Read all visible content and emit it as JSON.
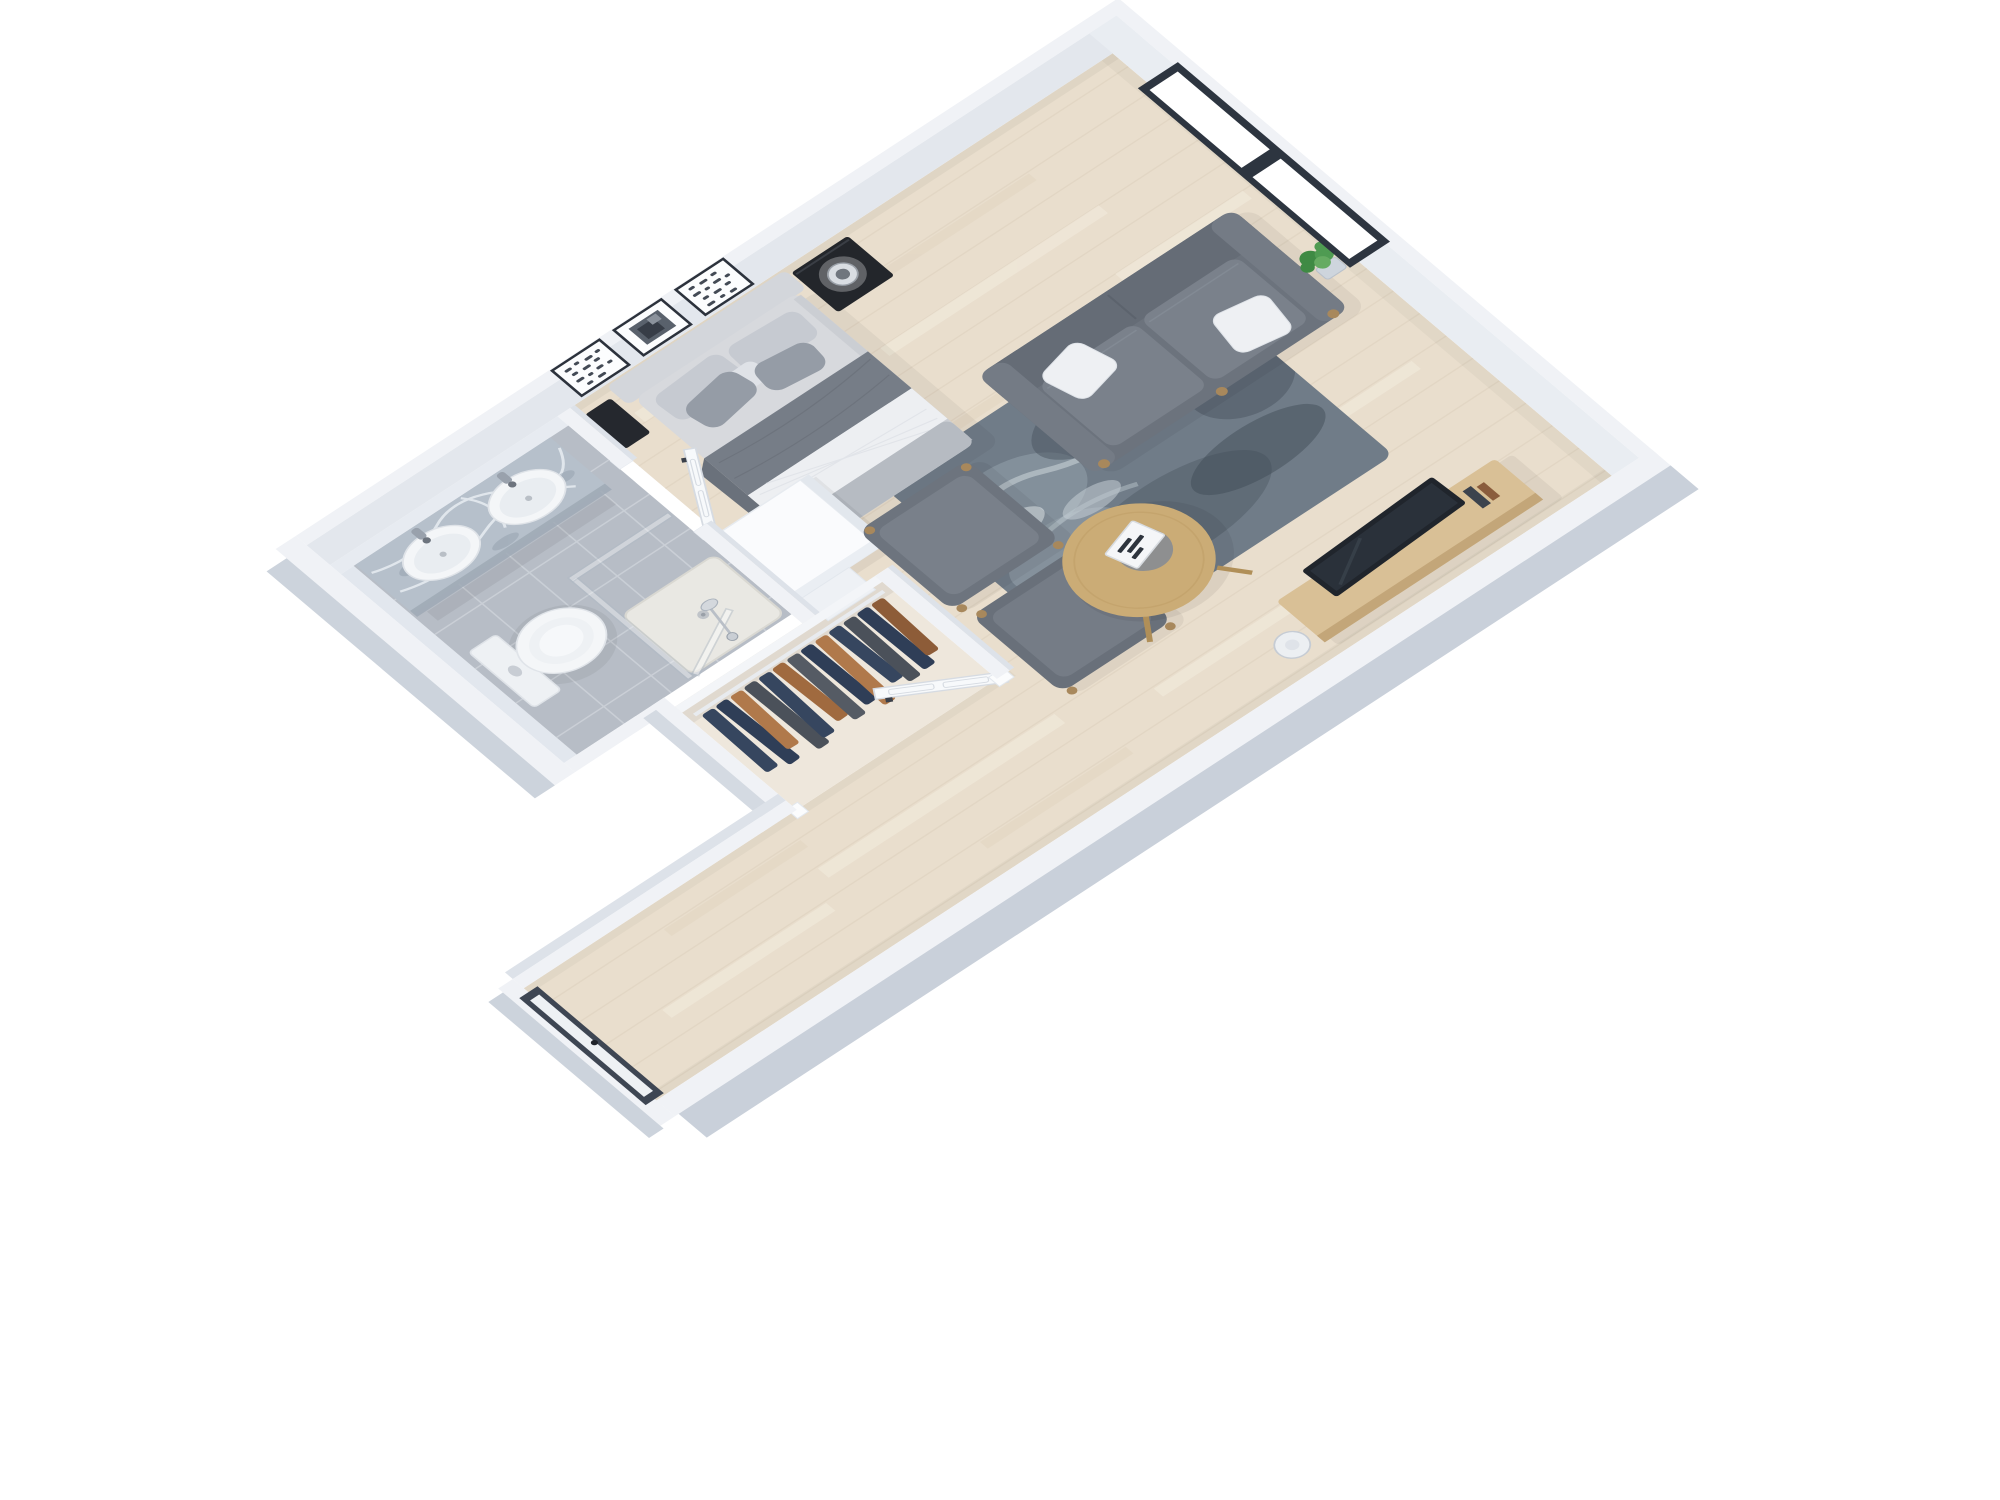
{
  "meta": {
    "title": "3D floor plan render of a studio apartment",
    "aria_label": "Isometric 3D floor plan showing a studio apartment with bedroom-living area, bathroom with double vanity and shower, wardrobe closet and entry hallway"
  },
  "palette": {
    "bg": "#ffffff",
    "wall_top": "#f0f2f6",
    "wall_face": "#e3e7ed",
    "wall_face_ne": "#e9edf2",
    "wall_outer": "#c9d0da",
    "wall_outer_light": "#ccd3dc",
    "floor_wood": "#e9decd",
    "floor_plank": "#ddd0bd",
    "floor_streak": "#f4ede0",
    "tile": "#b7bdc6",
    "tile_grout": "#ccd1d8",
    "closet_floor": "#eee7dc",
    "marble": "#b6c0cb",
    "marble_vein": "#e8edf2",
    "fixture_white": "#f4f6f8",
    "glass": "#aeb9c4",
    "shower_tray": "#e9e8e3",
    "headboard": "#d3d6db",
    "mattress": "#d7d9dd",
    "pillow_light": "#c6cad1",
    "pillow_dark": "#959ca6",
    "blanket_dark": "#767d87",
    "quilt_white": "#edeff2",
    "sheet_footer": "#b6bbc2",
    "nightstand_black": "#23262b",
    "lamp_glass": "#d9dde2",
    "sofa": "#6c737d",
    "sofa_seat": "#7a818b",
    "sofa_arm": "#747b85",
    "pillow_white": "#eef0f3",
    "leg_wood": "#a8885c",
    "ottoman": "#6d747e",
    "ottoman_top": "#79808a",
    "table_wood": "#cbac76",
    "table_edge": "#b08f58",
    "saucer": "#878c93",
    "book_white": "#f5f6f8",
    "rug_base": "#707c88",
    "rug_light": "#93a0ab",
    "rug_dark": "#4a545f",
    "rug_white": "#d6dde2",
    "console_wood": "#d9c096",
    "console_edge": "#c3a679",
    "tv_dark": "#20252c",
    "orb_lamp": "#eceff2",
    "plant_green": "#4f9b52",
    "plant_green_dark": "#3f8a44",
    "plant_green_light": "#66ab62",
    "door_white": "#f7f9fb",
    "door_line": "#d6dbe2",
    "handle_dark": "#3a404a",
    "frame_dark": "#2c323c",
    "art_mark": "#434a55",
    "window_frame": "#2d3540",
    "entry_frame": "#3e4653",
    "entry_glass": "#eef1f4",
    "cabinet_white": "#fafbfd"
  },
  "scene": {
    "rooms": [
      "bedroom-living-area",
      "bathroom",
      "wardrobe-closet",
      "hallway",
      "entry"
    ],
    "objects": [
      "double-bed",
      "headboard",
      "nightstand-left",
      "nightstand-right",
      "table-lamp",
      "wall-art-frame-1",
      "wall-art-frame-2",
      "wall-art-frame-3",
      "window",
      "sofa",
      "throw-pillows",
      "ottoman-1",
      "ottoman-2",
      "coffee-table",
      "book-tray",
      "area-rug",
      "tv-console",
      "television",
      "floor-lamp",
      "potted-plant",
      "double-vanity",
      "sink-left",
      "sink-right",
      "toilet",
      "walk-in-shower",
      "hanging-clothes",
      "bathroom-door",
      "closet-door",
      "entry-door",
      "white-cabinet"
    ]
  },
  "closet": {
    "garment_colors": [
      "#36465f",
      "#2f3e57",
      "#b0794b",
      "#4b515a",
      "#36465f",
      "#a06a3f",
      "#555b64",
      "#2f3e57",
      "#b0794b",
      "#36465f",
      "#4b515a",
      "#2f3e57",
      "#8d5c38"
    ]
  }
}
